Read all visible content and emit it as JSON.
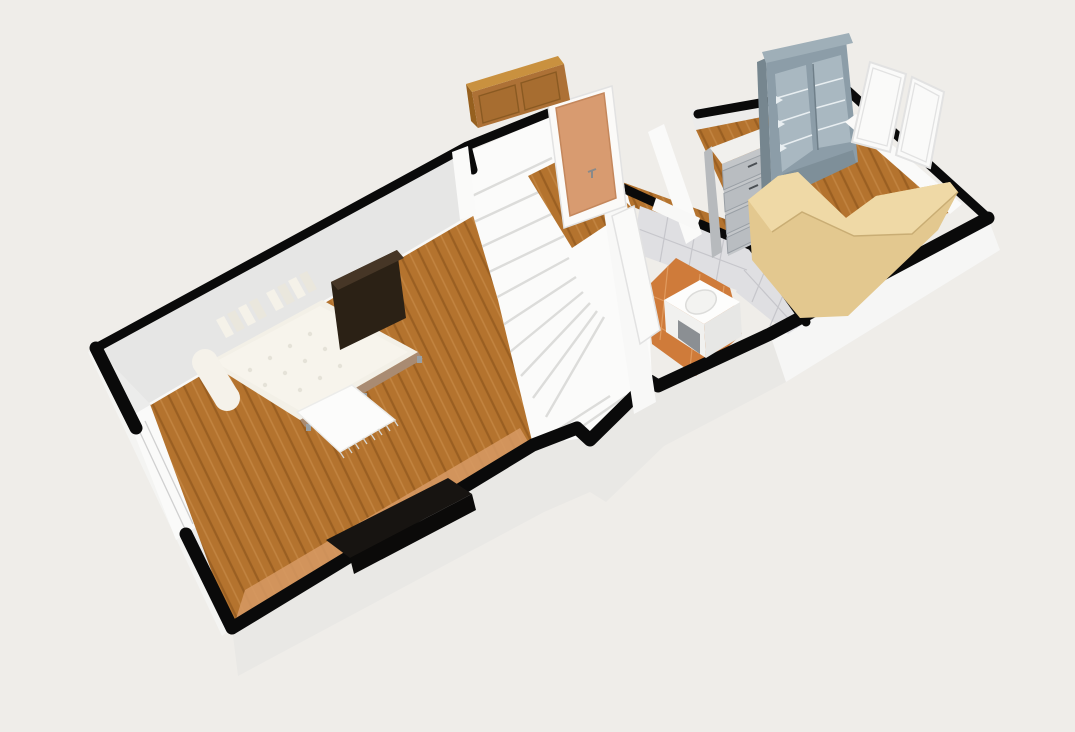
{
  "scene": {
    "kind": "3d-floorplan-render",
    "rooms": [
      {
        "id": "living-room",
        "floor": "wood-planks"
      },
      {
        "id": "staircase-winder",
        "floor": "white-steps"
      },
      {
        "id": "hallway-landing",
        "floor": "wood-planks"
      },
      {
        "id": "bathroom",
        "floor": "terracotta-tile"
      },
      {
        "id": "study",
        "floor": "wood-planks"
      }
    ],
    "furniture": [
      {
        "id": "daybed",
        "room": "living-room"
      },
      {
        "id": "dark-dresser",
        "room": "living-room"
      },
      {
        "id": "white-rug-table",
        "room": "living-room"
      },
      {
        "id": "tv-sideboard",
        "room": "living-room"
      },
      {
        "id": "front-door",
        "room": "hallway-landing"
      },
      {
        "id": "wall-cabinet",
        "room": "hallway-landing"
      },
      {
        "id": "bathroom-door",
        "room": "bathroom"
      },
      {
        "id": "vanity-sink",
        "room": "bathroom"
      },
      {
        "id": "marble-dresser",
        "room": "study"
      },
      {
        "id": "display-hutch",
        "room": "study"
      },
      {
        "id": "l-shaped-desk",
        "room": "study"
      },
      {
        "id": "balcony-windows",
        "room": "study"
      }
    ]
  },
  "colors": {
    "background": "#EFEDE9",
    "outline": "#0A0A0A",
    "interior_wall": "#E6E6E5",
    "interior_wall_left": "#ECECEB",
    "baseboard": "#F8F8F7",
    "exterior_band": "#E9E8E5",
    "exterior_band_bright": "#F6F6F5",
    "exterior_left_sliver": "#F4F4F2",
    "wood_base": "#B4732E",
    "wood_stripe": "#9A5F22",
    "wood_stripe2": "#C28441",
    "wood_light_strip": "#D79A64",
    "stair_white": "#FBFBFA",
    "stair_edge": "#DCDCDA",
    "door_frame": "#FBFAF8",
    "door_leaf": "#D89B70",
    "door_leaf_edge": "#C4875C",
    "handle_gray": "#8A8A8A",
    "wallcab_top": "#C9913F",
    "wallcab_front": "#AD7136",
    "wallcab_side": "#96601F",
    "wallcab_panel": "#A76D30",
    "wallcab_panel_edge": "#8A5A22",
    "tile_wall": "#DFDFE2",
    "tile_grout": "#C6C6CB",
    "bath_floor": "#CF7B3A",
    "bath_grout": "#E09A5E",
    "vanity_top": "#FDFDFC",
    "vanity_front": "#F1F1EF",
    "vanity_front2": "#E7E7E5",
    "vanity_inset": "#8B8F93",
    "basin": "#F3F3F1",
    "basin_edge": "#DCDCDA",
    "white_wall": "#F8F8F7",
    "white_wall2": "#FAFAF9",
    "study_backband": "#ECECEB",
    "hutch_front": "#8C9DA8",
    "hutch_side": "#76868F",
    "hutch_cornice": "#9FAFB8",
    "hutch_glass": "#A9B8C1",
    "hutch_shelf": "#E8EEF1",
    "hutch_lower": "#7E8F99",
    "hutch_line": "#6F7F89",
    "dresser_side": "#B7BABD",
    "dresser_marble": "#F1F0ED",
    "dresser_front": "#C3C6C9",
    "dresser_drawer": "#B9BDC1",
    "dresser_drawer_edge": "#999FA5",
    "dresser_handle": "#4A4F54",
    "desk_mass": "#E3C88F",
    "desk_top": "#EFD9A6",
    "desk_edge": "#C9AD74",
    "window_frame": "#FAFAF9",
    "window_edge": "#E2E2E2",
    "window_band_line": "#D0D0D0",
    "mattress": "#F3F0E7",
    "mattress_hi": "#F7F4EC",
    "tuft": "#E5E2D8",
    "pillow": "#F5F2E9",
    "pillow_alt": "#EAE7DD",
    "bolster": "#F5F2EA",
    "bed_frame": "#A98B72",
    "bed_leg": "#9AA0A4",
    "dark_dresser_top": "#463626",
    "dark_dresser_front": "#2B2115",
    "rug_white": "#FCFCFB",
    "rug_edge": "#ECECEA",
    "rug_fringe": "#D8D8D3",
    "tv_top": "#171411",
    "tv_front": "#0B0A09"
  }
}
